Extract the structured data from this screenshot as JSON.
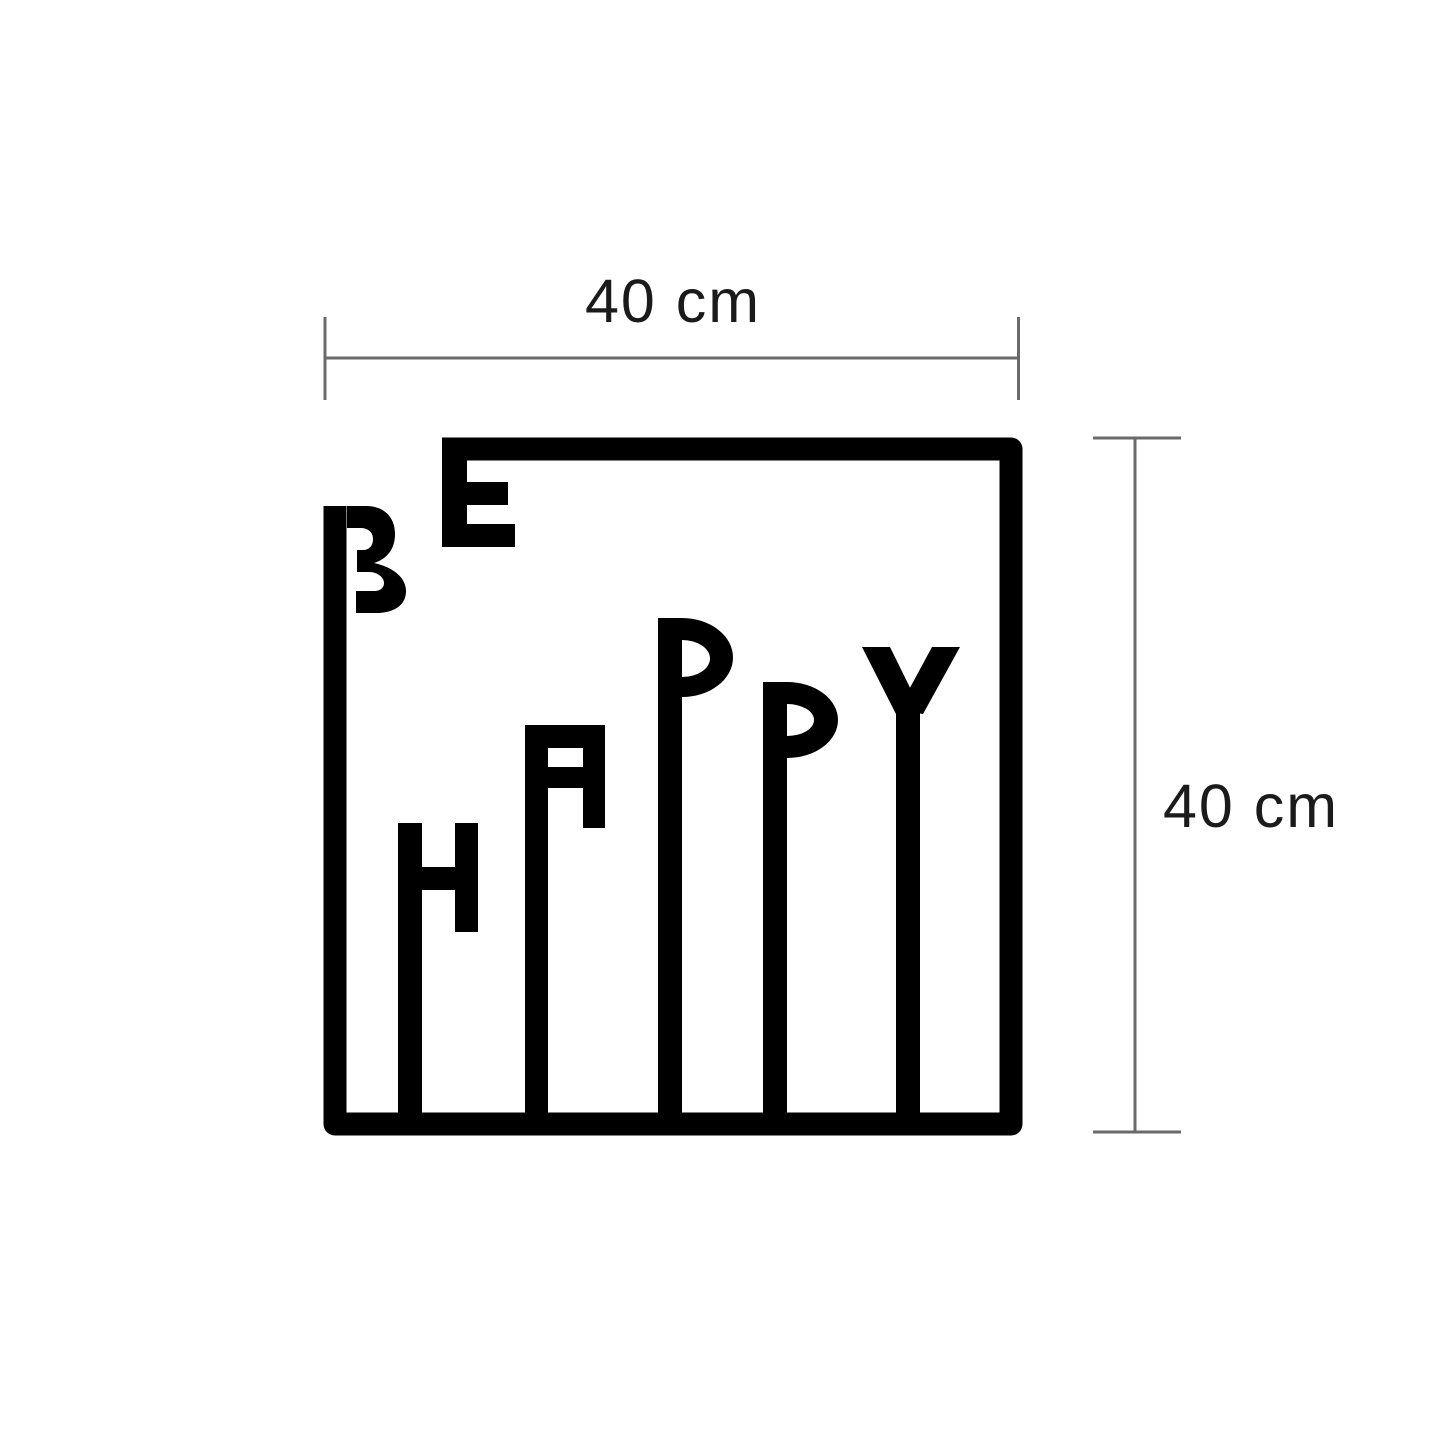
{
  "artwork": {
    "title": "BE HAPPY",
    "word_top": "BE",
    "word_bottom": "HAPPY",
    "letters": [
      "B",
      "E",
      "H",
      "A",
      "P",
      "P",
      "Y"
    ],
    "color": "#000000"
  },
  "dimensions": {
    "width": {
      "label": "40 cm"
    },
    "height": {
      "label": "40 cm"
    },
    "line_color": "#6a6a6a",
    "label_color": "#1b1b1b"
  }
}
